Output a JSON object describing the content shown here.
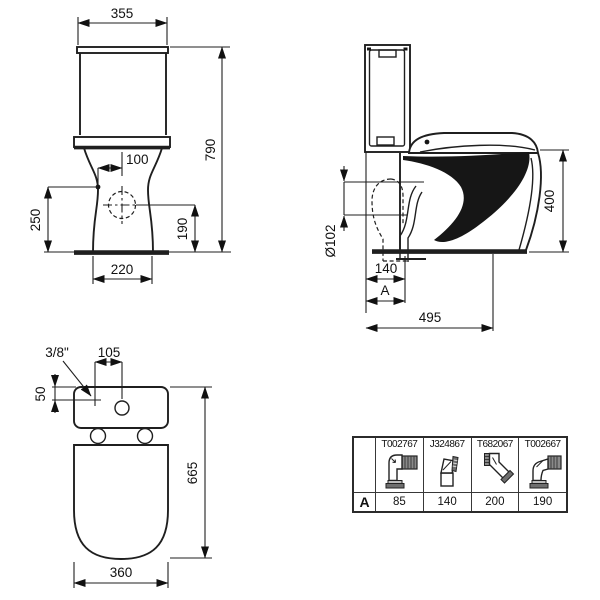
{
  "drawing": {
    "front_view": {
      "dim_width_top": "355",
      "dim_height_total": "790",
      "dim_inlet_offset": "100",
      "dim_inlet_height": "250",
      "dim_outlet_height": "190",
      "dim_base_width": "220"
    },
    "side_view": {
      "dim_seat_height": "400",
      "dim_outlet_diameter": "Ø102",
      "dim_outlet_distance": "140",
      "dim_variable_depth": "A",
      "dim_total_depth": "495"
    },
    "top_view": {
      "inlet_thread": "3/8\"",
      "dim_hole_offset": "105",
      "dim_inlet_depth": "50",
      "dim_total_length": "665",
      "dim_bowl_width": "360"
    }
  },
  "accessories_table": {
    "row_label": "A",
    "columns": [
      {
        "code": "T002767",
        "icon": "elbow-horizontal-outlet-icon",
        "value": "85"
      },
      {
        "code": "J324867",
        "icon": "angled-straight-connector-icon",
        "value": "140"
      },
      {
        "code": "T682067",
        "icon": "45-degree-bend-connector-icon",
        "value": "200"
      },
      {
        "code": "T002667",
        "icon": "offset-elbow-connector-icon",
        "value": "190"
      }
    ],
    "colors": {
      "line": "#1f1f1f",
      "ribbed_fill": "#8a8a8a",
      "flange_fill": "#6e6e6e"
    }
  }
}
